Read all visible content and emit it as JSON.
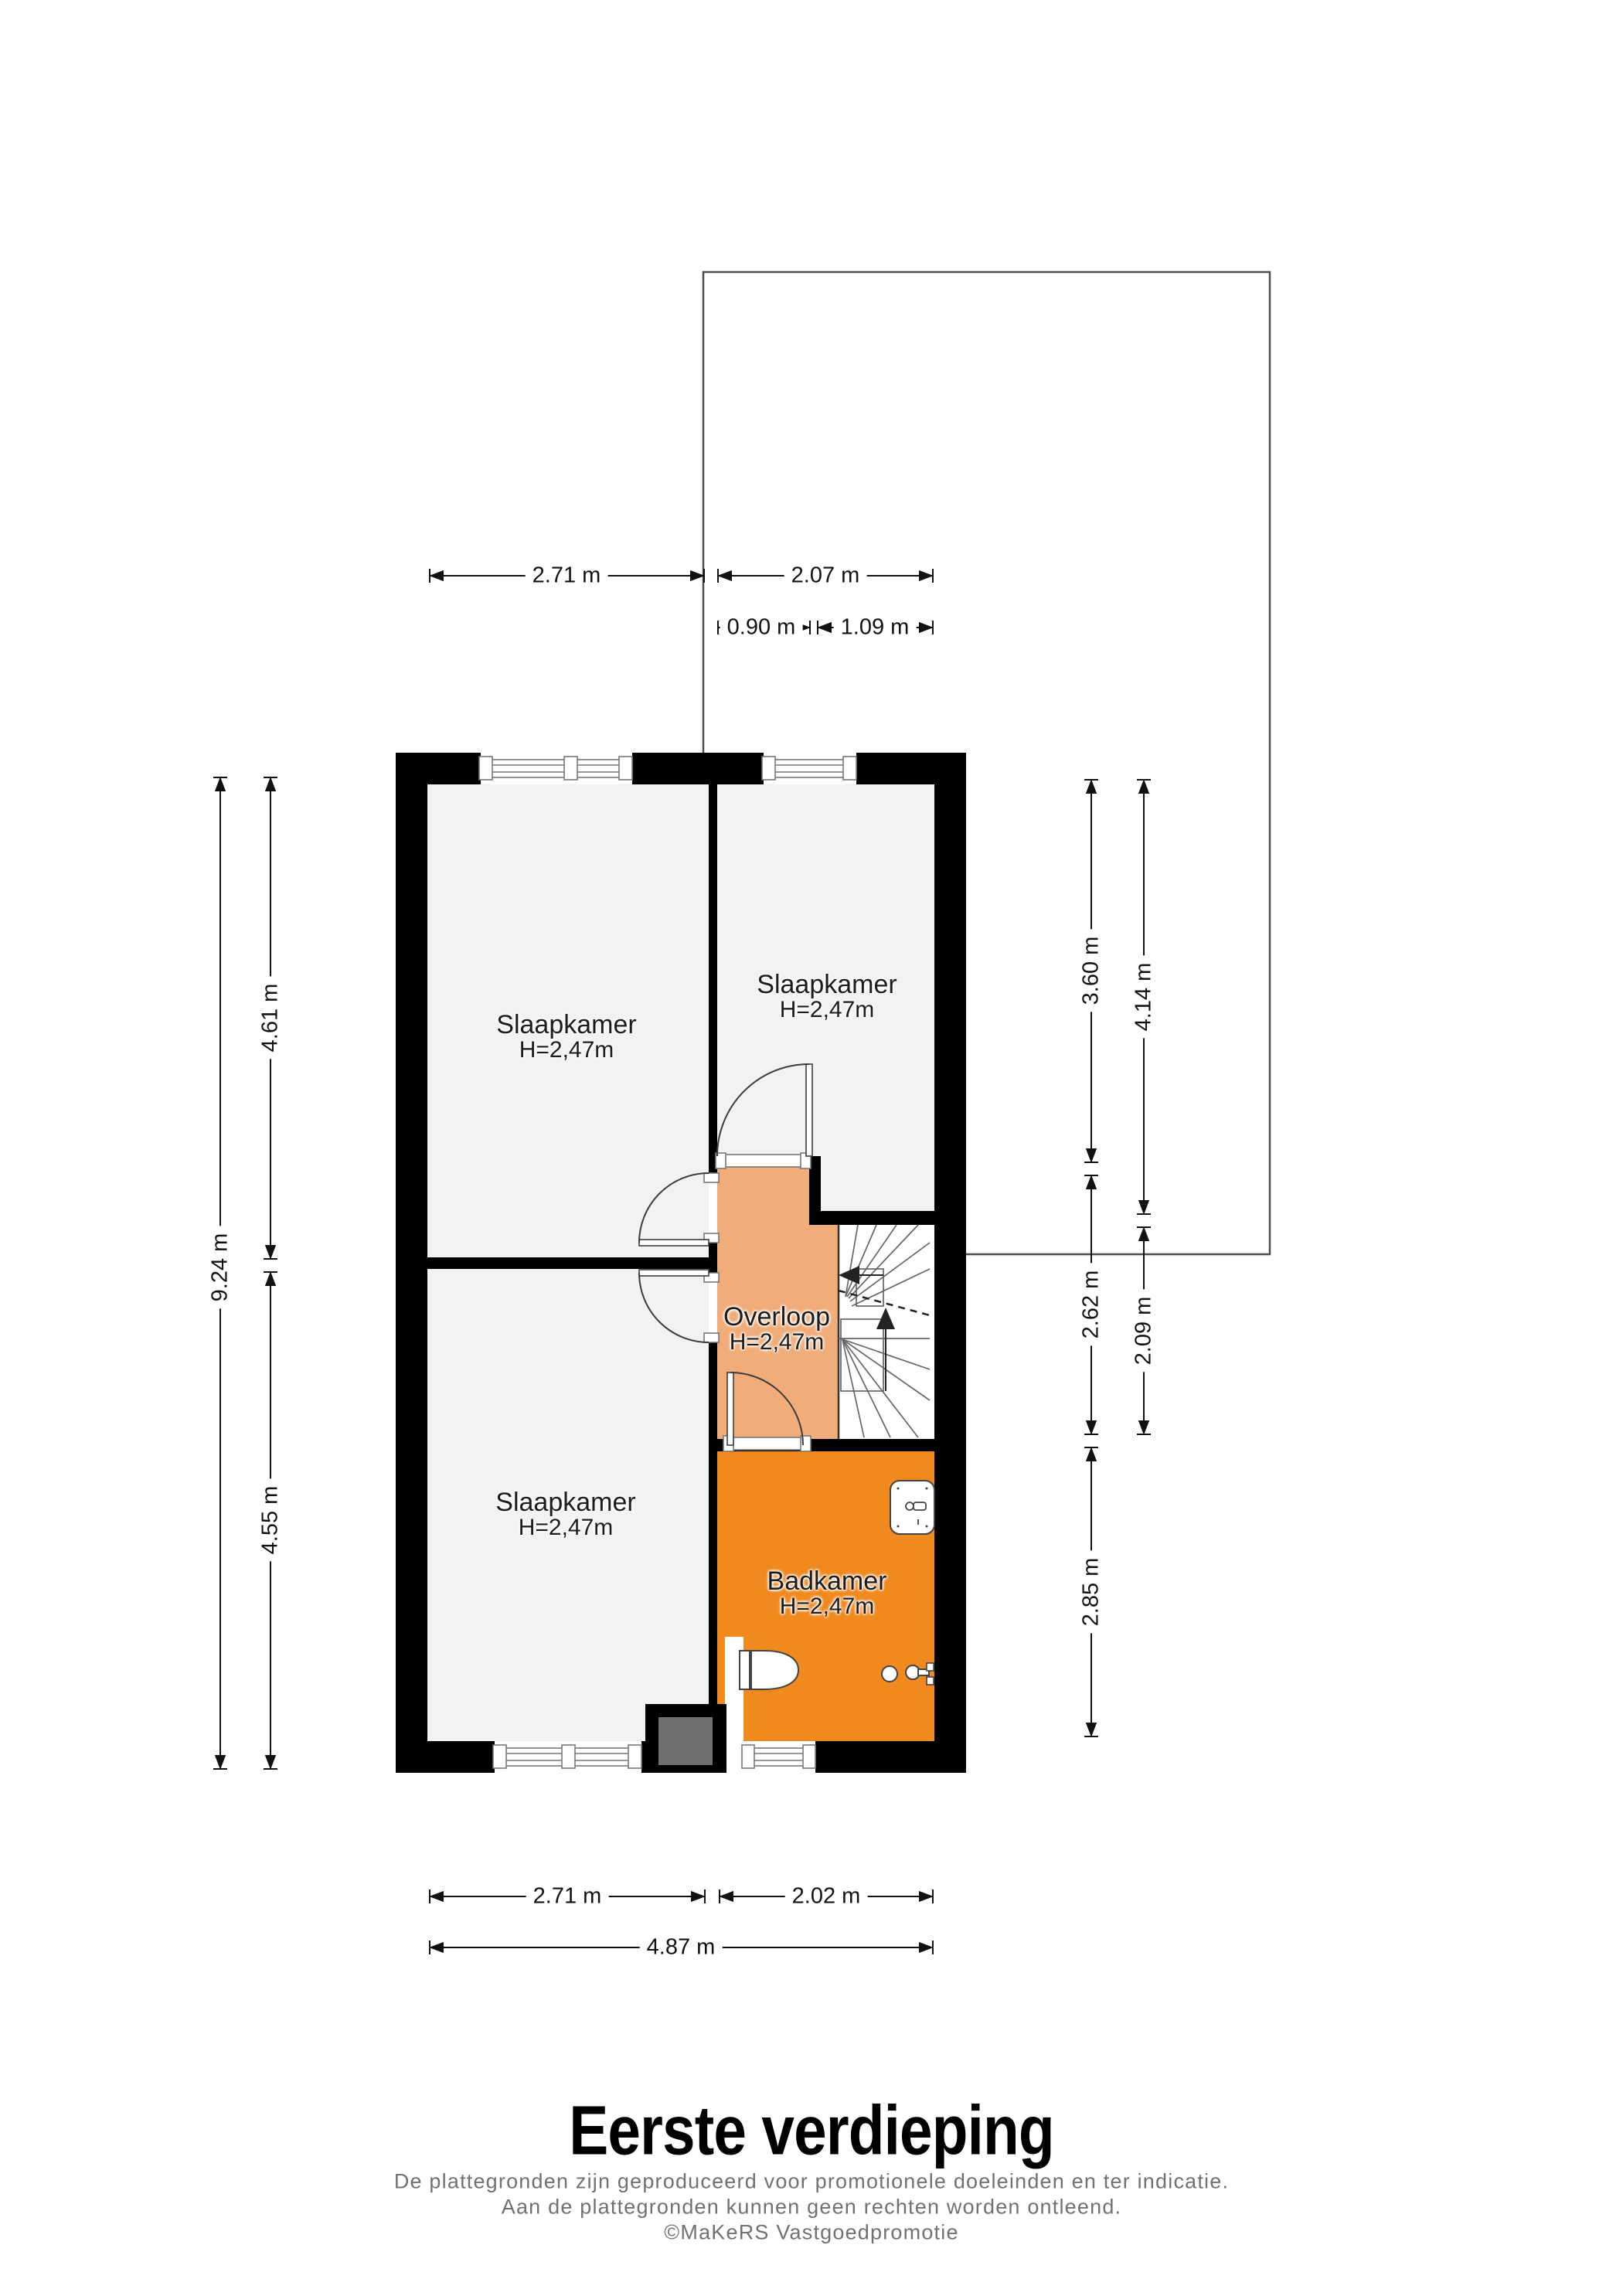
{
  "title": "Eerste verdieping",
  "disclaimer": {
    "line1": "De plattegronden zijn geproduceerd voor promotionele doeleinden en ter indicatie.",
    "line2": "Aan de plattegronden kunnen geen rechten worden ontleend.",
    "line3": "©MaKeRS Vastgoedpromotie"
  },
  "rooms": {
    "slaapkamer_top_left": {
      "name": "Slaapkamer",
      "height": "H=2,47m"
    },
    "slaapkamer_top_right": {
      "name": "Slaapkamer",
      "height": "H=2,47m"
    },
    "slaapkamer_bottom_left": {
      "name": "Slaapkamer",
      "height": "H=2,47m"
    },
    "overloop": {
      "name": "Overloop",
      "height": "H=2,47m"
    },
    "badkamer": {
      "name": "Badkamer",
      "height": "H=2,47m"
    }
  },
  "dimensions": {
    "top_left_width": "2.71 m",
    "top_right_width": "2.07 m",
    "top_sub_left": "0.90 m",
    "top_sub_right": "1.09 m",
    "left_total_height": "9.24 m",
    "left_upper_height": "4.61 m",
    "left_lower_height": "4.55 m",
    "right_top": "3.60 m",
    "right_middle": "2.62 m",
    "right_bottom": "2.85 m",
    "right_outer_top": "4.14 m",
    "right_outer_middle": "2.09 m",
    "bottom_left_width": "2.71 m",
    "bottom_right_width": "2.02 m",
    "bottom_total_width": "4.87 m"
  },
  "colors": {
    "wall": "#000000",
    "bedroom_floor": "#F2F2F2",
    "overloop_floor": "#F0AD79",
    "badkamer_floor": "#F0891E",
    "stair_white": "#FFFFFF",
    "duct_gray": "#6F6F6F",
    "outline_gray": "#4D4D4D"
  }
}
